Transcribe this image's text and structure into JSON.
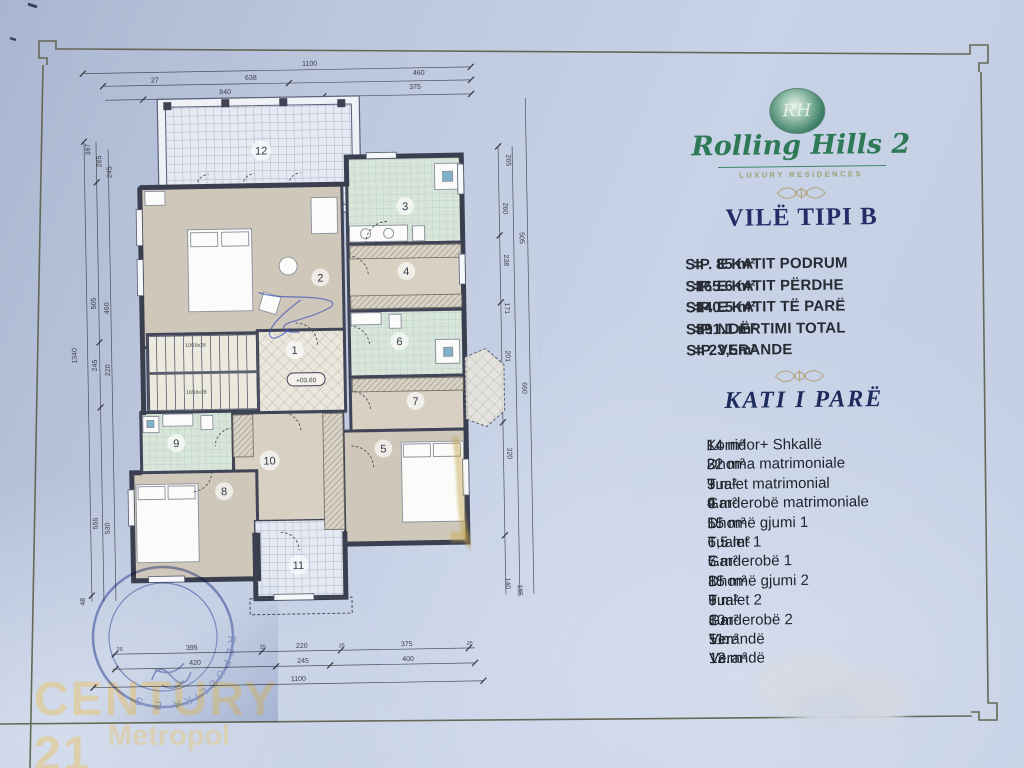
{
  "panel": {
    "logo": {
      "monogram": "RH",
      "name": "Rolling Hills 2",
      "tagline": "LUXURY RESIDENCES"
    },
    "villa_title": "VILË TIPI B",
    "areas": [
      {
        "label": "SIP. E KATIT PODRUM",
        "eq": "=",
        "value": "85 m²"
      },
      {
        "label": "SIP. E KATIT PËRDHE",
        "eq": "=",
        "value": "165.6 m²"
      },
      {
        "label": "SIP. E KATIT TË PARË",
        "eq": "=",
        "value": "140.5 m²"
      },
      {
        "label": "SIP. NDËRTIMI TOTAL",
        "eq": "=",
        "value": "391.1 m²"
      },
      {
        "label": "SIP. VERANDE",
        "eq": "=",
        "value": "23,5m²"
      }
    ],
    "floor_title": "KATI I PARË",
    "rooms": [
      {
        "no": "1.",
        "name": "Korridor+ Shkallë",
        "area": "14 m²"
      },
      {
        "no": "2.",
        "name": "Dhoma matrimoniale",
        "area": "32 m²"
      },
      {
        "no": "3.",
        "name": "Tualet matrimonial",
        "area": "9 m²"
      },
      {
        "no": "4.",
        "name": "Garderobë matrimoniale",
        "area": "9 m²"
      },
      {
        "no": "5.",
        "name": "Dhomë gjumi 1",
        "area": "15 m²"
      },
      {
        "no": "6.",
        "name": "Tualet 1",
        "area": "6,5 m²"
      },
      {
        "no": "7.",
        "name": "Garderobë 1",
        "area": "5 m²"
      },
      {
        "no": "8.",
        "name": "Dhomë gjumi 2",
        "area": "15 m²"
      },
      {
        "no": "9.",
        "name": "Tualet 2",
        "area": "6 m²"
      },
      {
        "no": "10.",
        "name": "Garderobë 2",
        "area": "8 m²"
      },
      {
        "no": "11.",
        "name": "Verandë",
        "area": "5 m²"
      },
      {
        "no": "12.",
        "name": "Verandë",
        "area": "13 m²"
      }
    ]
  },
  "plan": {
    "rooms": {
      "n1": "1",
      "n2": "2",
      "n3": "3",
      "n4": "4",
      "n5": "5",
      "n6": "6",
      "n7": "7",
      "n8": "8",
      "n9": "9",
      "n10": "10",
      "n11": "11",
      "n12": "12"
    },
    "elevation": "+03.60",
    "stair_note": "10/18x28",
    "dims": {
      "top": [
        "1100",
        "27",
        "638",
        "460",
        "840",
        "375"
      ],
      "bottom": [
        "395",
        "220",
        "375",
        "420",
        "245",
        "400",
        "1100"
      ],
      "small25": "25",
      "left": [
        "387",
        "265",
        "245",
        "505",
        "460",
        "245",
        "220",
        "555",
        "530",
        "48",
        "1340"
      ],
      "right": [
        "265",
        "260",
        "505",
        "238",
        "171",
        "201",
        "660",
        "320",
        "140",
        "185",
        "1285"
      ]
    }
  },
  "stamp": {
    "arc_text": "REPUBLIKA E S"
  },
  "watermark": {
    "line1": "CENTURY 21",
    "line2": "Metropol"
  }
}
